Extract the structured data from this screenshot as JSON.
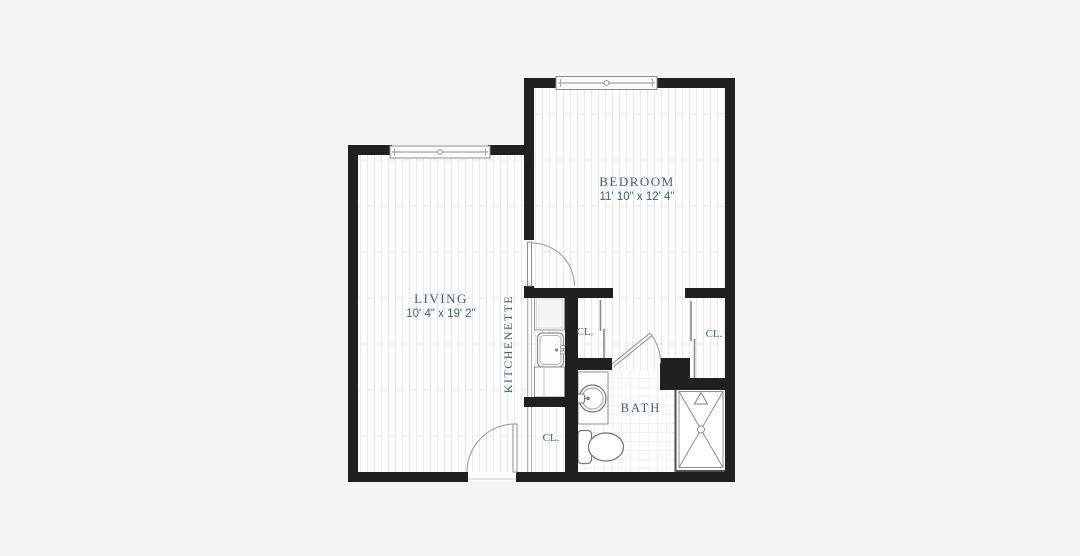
{
  "title": "One-bedroom apartment floor plan",
  "colors": {
    "background": "#f5f5f6",
    "wall": "#202020",
    "floor": "#fefefe",
    "floor_line": "#e9e9ed",
    "tile_line": "#e7e7eb",
    "ink": "#4a5c70",
    "fixture": "#8f8f8f"
  },
  "labels": {
    "living": "LIVING",
    "living_dims": "10' 4\" x 19' 2\"",
    "bedroom": "BEDROOM",
    "bedroom_dims": "11' 10\" x 12' 4\"",
    "kitchenette": "KITCHENETTE",
    "bath": "BATH",
    "closet_middle": "CL.",
    "closet_right": "CL.",
    "closet_entry": "CL."
  }
}
